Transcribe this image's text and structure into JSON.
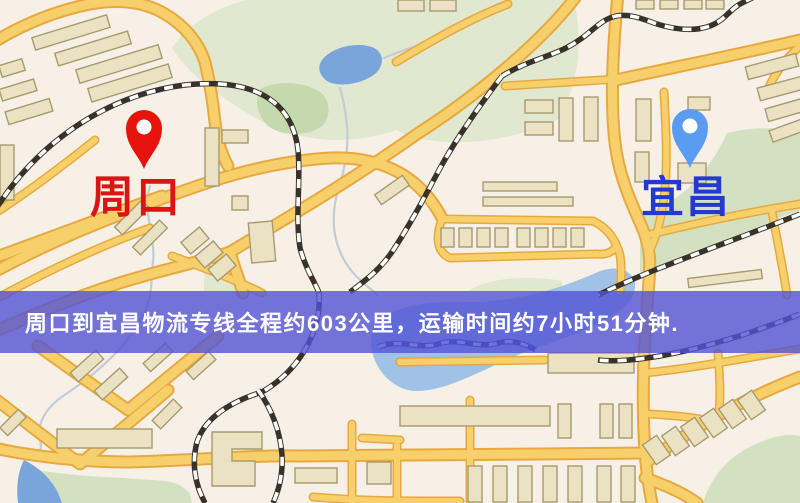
{
  "banner": {
    "text": "周口到宜昌物流专线全程约603公里，运输时间约7小时51分钟."
  },
  "markers": {
    "origin": {
      "label": "周口",
      "icon": "red-map-pin-icon",
      "pin_color": "#e8130c",
      "label_color": "#dc1413"
    },
    "destination": {
      "label": "宜昌",
      "icon": "blue-map-pin-icon",
      "pin_color": "#5b9bf2",
      "label_color": "#2339cf"
    }
  },
  "route": {
    "distance_text": "603公里",
    "duration_text": "7小时51分钟"
  },
  "colors": {
    "background": "#f6f0e7",
    "park": "#d3e1c0",
    "park_light": "#e0e8d0",
    "park_dark": "#c5d9ae",
    "water": "#79a5da",
    "water_light": "#9fc2e6",
    "stream": "#c3ccd6",
    "road_casing": "#e7a93f",
    "road_fill": "#f8d06b",
    "rail_dark": "#38322a",
    "rail_navy": "#2c3e92",
    "building_fill": "#ebe2c4",
    "building_stroke": "#a89a6e",
    "origin_pin": "#e8130c",
    "origin_label": "#dc1413",
    "destination_pin": "#5b9bf2",
    "destination_label": "#2339cf",
    "banner_bg": "rgba(83,82,213,0.8)",
    "banner_text": "#ffffff"
  }
}
